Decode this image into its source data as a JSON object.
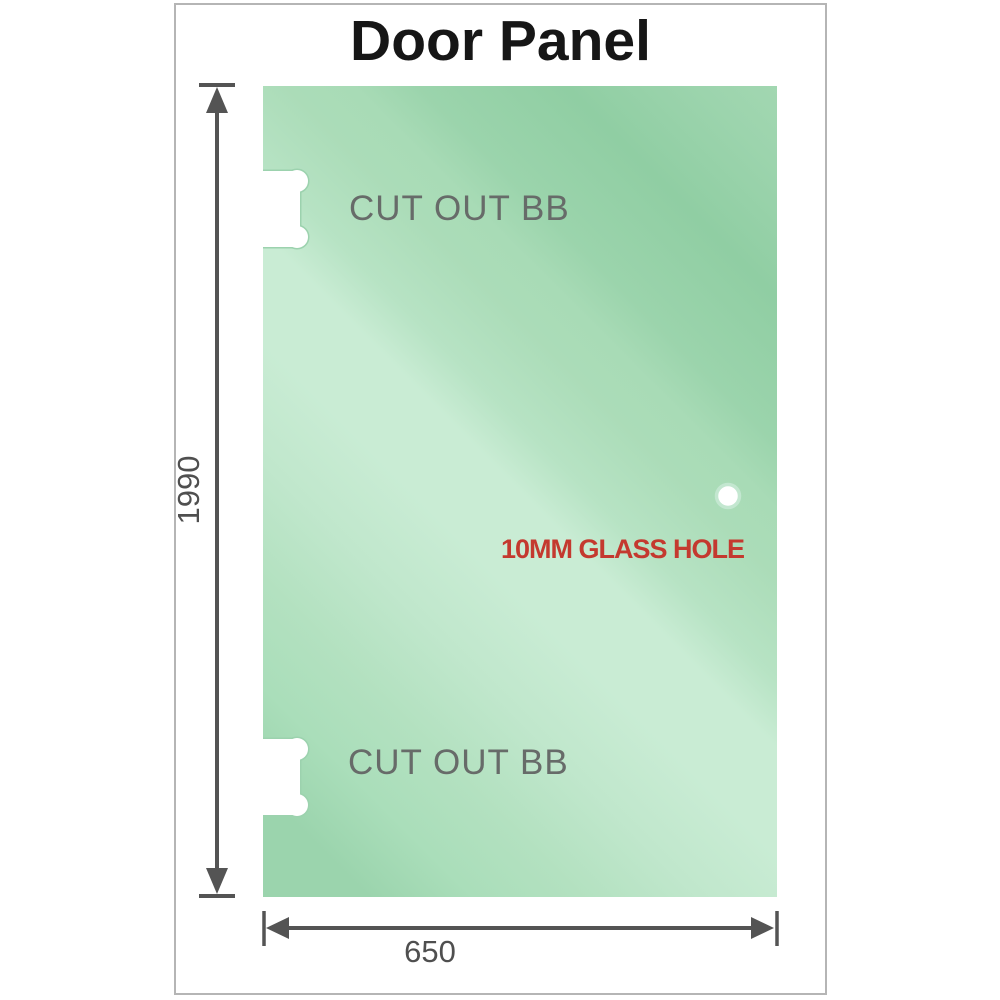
{
  "title": "Door Panel",
  "panel": {
    "cutout_top_label": "CUT OUT BB",
    "cutout_bottom_label": "CUT OUT BB",
    "hole_label": "10MM GLASS HOLE"
  },
  "dimensions": {
    "height": "1990",
    "width": "650"
  },
  "colors": {
    "glass_green_dark": "#90cea3",
    "glass_green_base": "#a8dbb6",
    "glass_green_light": "#c9ecd4",
    "cutout_rim_green": "#9cd2ae",
    "dimension_line_gray": "#545454",
    "dimension_text_gray": "#4f4f4f",
    "cutout_label_gray": "#676b69",
    "hole_label_red": "#c4392f",
    "title_black": "#161616",
    "frame_border_gray": "#b5b5b5"
  }
}
